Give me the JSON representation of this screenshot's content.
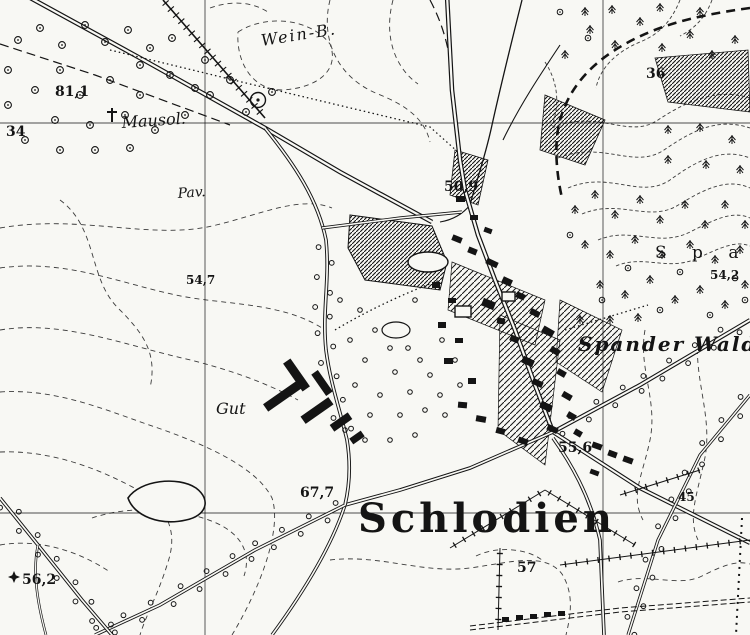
{
  "map": {
    "type": "historical-topographic-map",
    "title": "Schlodien",
    "region_labels": {
      "wein_b": "Wein-B.",
      "mausol": "Mausol.",
      "pav": "Pav.",
      "gut": "Gut",
      "span_spread": "S p a n",
      "spander_wald": "Spander Wald",
      "schlodien": "Schlodien"
    },
    "spot_heights": {
      "h34": "34",
      "h81_1": "81,1",
      "h36": "36",
      "h50_9": "50,9",
      "h54_7": "54,7",
      "h54_2": "54,2",
      "h55_6": "55,6",
      "h67_7": "67,7",
      "h45": "45",
      "h56_2": "56,2",
      "h57": "57"
    },
    "colors": {
      "ink": "#141414",
      "paper": "#f8f8f4",
      "contour": "#3b3b3b"
    }
  }
}
